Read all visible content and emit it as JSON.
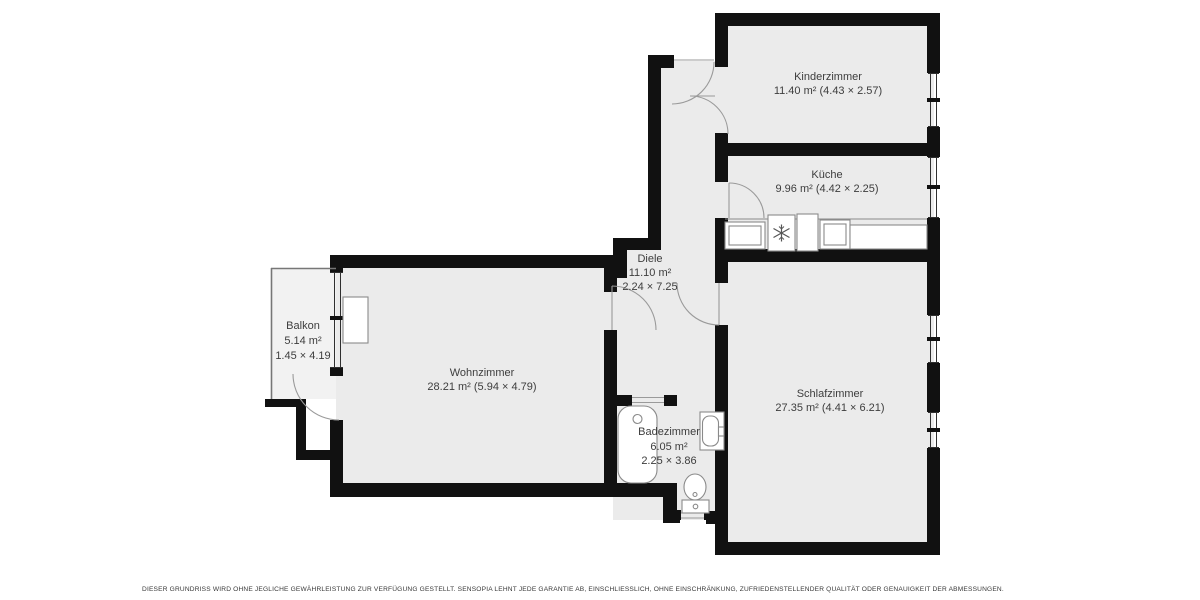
{
  "title": "floor-plan",
  "rooms": [
    {
      "id": "kinderzimmer",
      "lines": [
        "Kinderzimmer",
        "11.40 m² (4.43 × 2.57)"
      ]
    },
    {
      "id": "kueche",
      "lines": [
        "Küche",
        "9.96 m² (4.42 × 2.25)"
      ]
    },
    {
      "id": "diele",
      "lines": [
        "Diele",
        "11.10 m²",
        "2.24 × 7.25"
      ]
    },
    {
      "id": "balkon",
      "lines": [
        "Balkon",
        "5.14 m²",
        "1.45 × 4.19"
      ]
    },
    {
      "id": "wohnzimmer",
      "lines": [
        "Wohnzimmer",
        "28.21 m² (5.94 × 4.79)"
      ]
    },
    {
      "id": "badezimmer",
      "lines": [
        "Badezimmer",
        "6.05 m²",
        "2.25 × 3.86"
      ]
    },
    {
      "id": "schlafzimmer",
      "lines": [
        "Schlafzimmer",
        "27.35 m² (4.41 × 6.21)"
      ]
    }
  ],
  "fixtures": {
    "kitchen": [
      "sink-counter",
      "refrigerator-snowflake",
      "cabinet",
      "stove-oven",
      "countertop"
    ],
    "bathroom": [
      "bathtub",
      "washbasin",
      "toilet"
    ],
    "living_room": [
      "radiator"
    ]
  },
  "colors": {
    "wall": "#111111",
    "floor": "#ebebeb",
    "balcony_floor": "#f2f2f2",
    "window_stroke": "#2f2f2f",
    "door_stroke": "#9a9a9a",
    "fixture_stroke": "#8a8a8a",
    "label_text": "#3d3d3d",
    "footer_text": "#383838"
  },
  "footer": {
    "disclaimer": "DIESER GRUNDRISS WIRD OHNE JEGLICHE GEWÄHRLEISTUNG ZUR VERFÜGUNG GESTELLT. SENSOPIA LEHNT JEDE GARANTIE AB, EINSCHLIESSLICH, OHNE EINSCHRÄNKUNG, ZUFRIEDENSTELLENDER QUALITÄT ODER GENAUIGKEIT DER ABMESSUNGEN."
  }
}
